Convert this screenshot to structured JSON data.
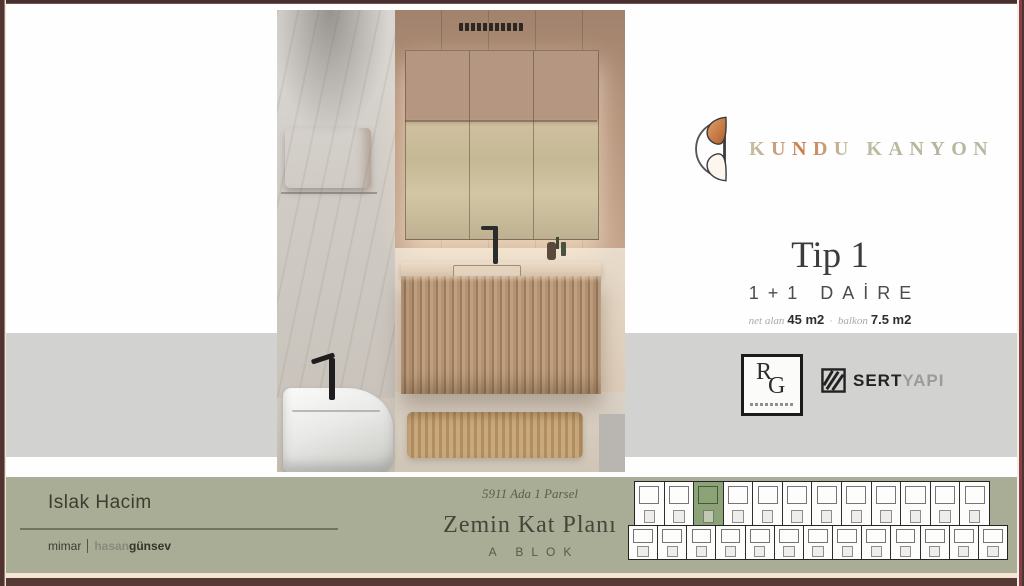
{
  "brand": {
    "name": "KUNDU KANYON"
  },
  "unit": {
    "type_title": "Tip 1",
    "layout": "1+1 DAİRE",
    "area_separator": "·",
    "areas": [
      {
        "label": "net alan",
        "value": "45 m2"
      },
      {
        "label": "balkon",
        "value": "7.5 m2"
      }
    ]
  },
  "partners": {
    "rg_r": "R",
    "rg_g": "G",
    "sert_bold": "SERT",
    "sert_light": "YAPI"
  },
  "footer": {
    "room_title": "Islak Hacim",
    "credit_role": "mimar",
    "credit_first": "hasan",
    "credit_last": "günsev",
    "plan_script": "5911 Ada 1 Parsel",
    "plan_title": "Zemin Kat Planı",
    "block_label": "A BLOK"
  },
  "floorplan": {
    "top_units": 12,
    "bottom_units": 13,
    "highlighted_unit": 2
  },
  "colors": {
    "sage": "#a9ad95",
    "gray_band": "#d2d2d0",
    "frame": "#543833",
    "accent_copper": "#c07a4a",
    "highlight": "#8ca377"
  }
}
